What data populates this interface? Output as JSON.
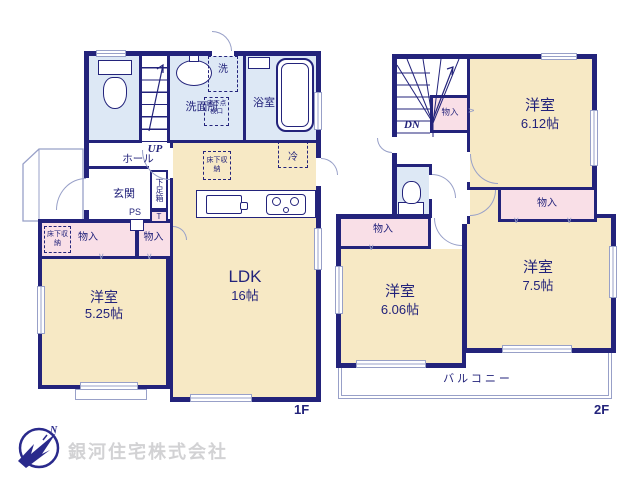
{
  "colors": {
    "wall": "#23237b",
    "room": "#f7e9c5",
    "closet": "#f9dfe7",
    "wet": "#dde8f5",
    "thin": "#98a0c8",
    "logo-text": "#d2d2d4",
    "logo-mark": "#2a2a8c"
  },
  "company": {
    "name": "銀河住宅株式会社"
  },
  "floor1": {
    "floor_label": "1F",
    "up": "UP",
    "hall": "ホール",
    "entrance": "玄関",
    "shoe_box": "下足箱",
    "shoe_box_t": "T",
    "ps": "PS",
    "washroom": "洗面所",
    "laundry": "洗",
    "inspection": "床下点検口",
    "bath": "浴室",
    "fridge": "冷",
    "underfloor_ldk": "床下収納",
    "underfloor_closet": "床下収納",
    "closet_left": "物入",
    "closet_right": "物入",
    "ldk": {
      "name": "LDK",
      "size": "16帖"
    },
    "west_room": {
      "name": "洋室",
      "size": "5.25帖"
    }
  },
  "floor2": {
    "floor_label": "2F",
    "dn": "DN",
    "closet_stairs": "物入",
    "closet_right": "物入",
    "closet_left": "物入",
    "room_612": {
      "name": "洋室",
      "size": "6.12帖"
    },
    "room_606": {
      "name": "洋室",
      "size": "6.06帖"
    },
    "room_75": {
      "name": "洋室",
      "size": "7.5帖"
    },
    "balcony": "バルコニー"
  }
}
